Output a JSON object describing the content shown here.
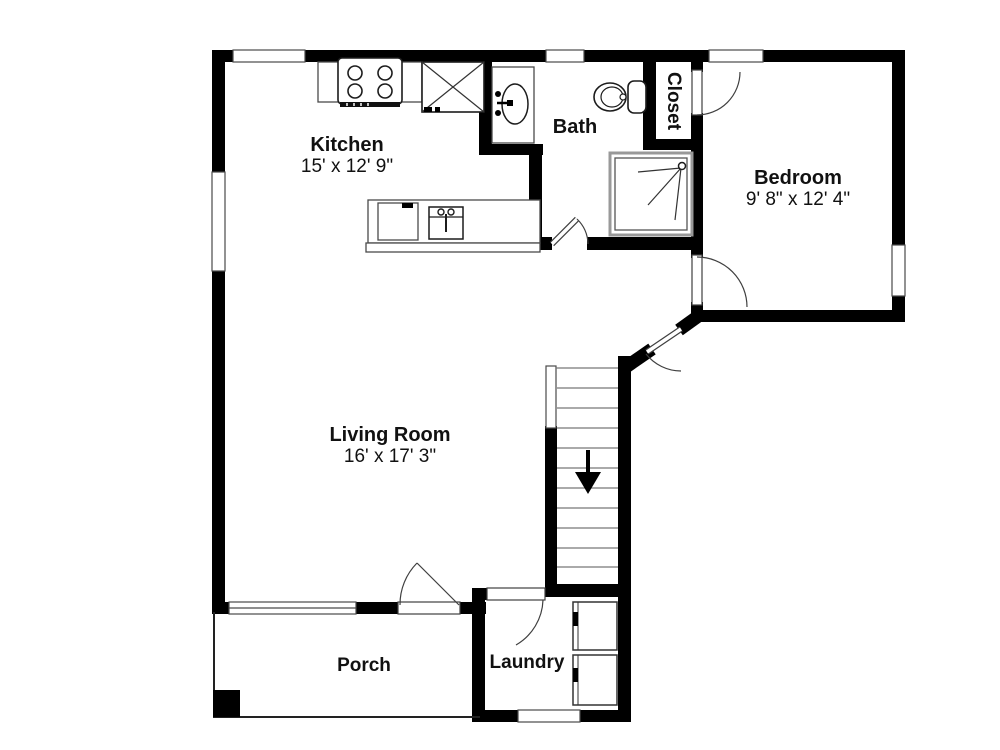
{
  "plan": {
    "type": "residential floor plan",
    "colors": {
      "background": "#ffffff",
      "walls": "#000000",
      "fixtures": "#3a3a3a",
      "text": "#111111"
    },
    "rooms": {
      "kitchen": {
        "name": "Kitchen",
        "dims": "15' x 12' 9\""
      },
      "bath": {
        "name": "Bath"
      },
      "closet": {
        "name": "Closet"
      },
      "bedroom": {
        "name": "Bedroom",
        "dims": "9' 8\" x 12' 4\""
      },
      "living_room": {
        "name": "Living Room",
        "dims": "16' x 17' 3\""
      },
      "porch": {
        "name": "Porch"
      },
      "laundry": {
        "name": "Laundry"
      }
    },
    "fixtures": [
      "stove-4-burner",
      "refrigerator",
      "kitchen-island-counter",
      "dishwasher",
      "island-sink",
      "bath-sink",
      "toilet",
      "shower",
      "stairs",
      "washer",
      "dryer",
      "porch-post"
    ],
    "icons": {
      "stairs-down-arrow": "↓"
    },
    "counts": {
      "windows": 7,
      "doors": 6,
      "stair_treads": 10
    }
  }
}
